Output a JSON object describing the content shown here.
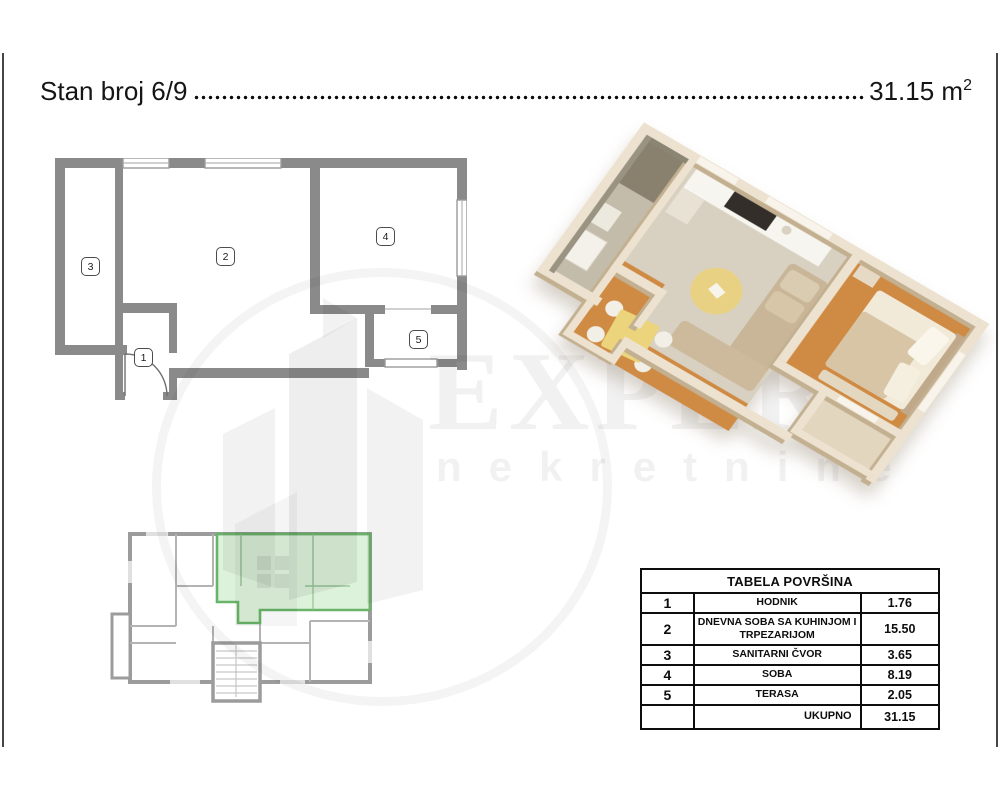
{
  "title": {
    "label": "Stan broj 6/9",
    "area_value": "31.15 m",
    "area_sup": "2"
  },
  "floor_plan_2d": {
    "labels": [
      "1",
      "2",
      "3",
      "4",
      "5"
    ],
    "wall_color": "#8a8a8a"
  },
  "position_plan": {
    "highlight_fill": "#d6efd2",
    "highlight_border": "#69b469"
  },
  "plan_3d": {
    "wall_color": "#ece2cf",
    "wood_floor_color": "#cf8a43",
    "carpet_color": "#d8d1c2"
  },
  "watermark": {
    "brand": "EXPERT",
    "subtitle": "nekretnine"
  },
  "area_table": {
    "title": "TABELA POVRŠINA",
    "rows": [
      {
        "num": "1",
        "name": "HODNIK",
        "area": "1.76"
      },
      {
        "num": "2",
        "name": "DNEVNA SOBA SA KUHINJOM I TRPEZARIJOM",
        "area": "15.50"
      },
      {
        "num": "3",
        "name": "SANITARNI ČVOR",
        "area": "3.65"
      },
      {
        "num": "4",
        "name": "SOBA",
        "area": "8.19"
      },
      {
        "num": "5",
        "name": "TERASA",
        "area": "2.05"
      }
    ],
    "total_label": "UKUPNO",
    "total_value": "31.15"
  }
}
